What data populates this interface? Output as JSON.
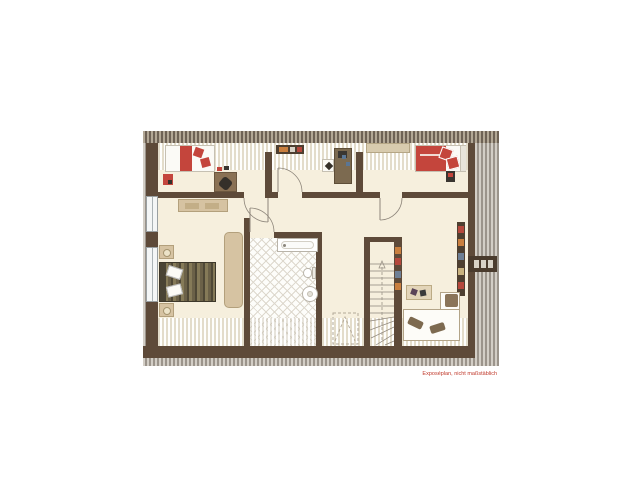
{
  "plan": {
    "type": "floor-plan",
    "floor_label": "",
    "disclaimer": "Exposéplan, nicht maßstäblich",
    "colors": {
      "background": "#ffffff",
      "wall": "#5e4a39",
      "floor": "#f6efdd",
      "roof_hatch_dark": "#6e6255",
      "roof_hatch_light": "#9b948b",
      "tile_grid": "#ddd8cd",
      "furniture_tan": "#d6c3a2",
      "accent_red": "#c4453c",
      "bed_olive": "#5d553f",
      "sofa_brown": "#8a7459",
      "disclaimer_red": "#c0392b"
    },
    "elements": [
      "bed-single-left",
      "desk-left",
      "chair-red",
      "dresser-top",
      "desk-middle",
      "shelf-long",
      "bed-single-right",
      "sideboard",
      "bed-double",
      "nightstand-lamp",
      "bench",
      "bathtub",
      "toilet",
      "washbasin",
      "staircase",
      "skylight-dashed",
      "bookshelf",
      "chimney",
      "coffee-table",
      "corner-sofa",
      "window",
      "door-arc"
    ]
  }
}
